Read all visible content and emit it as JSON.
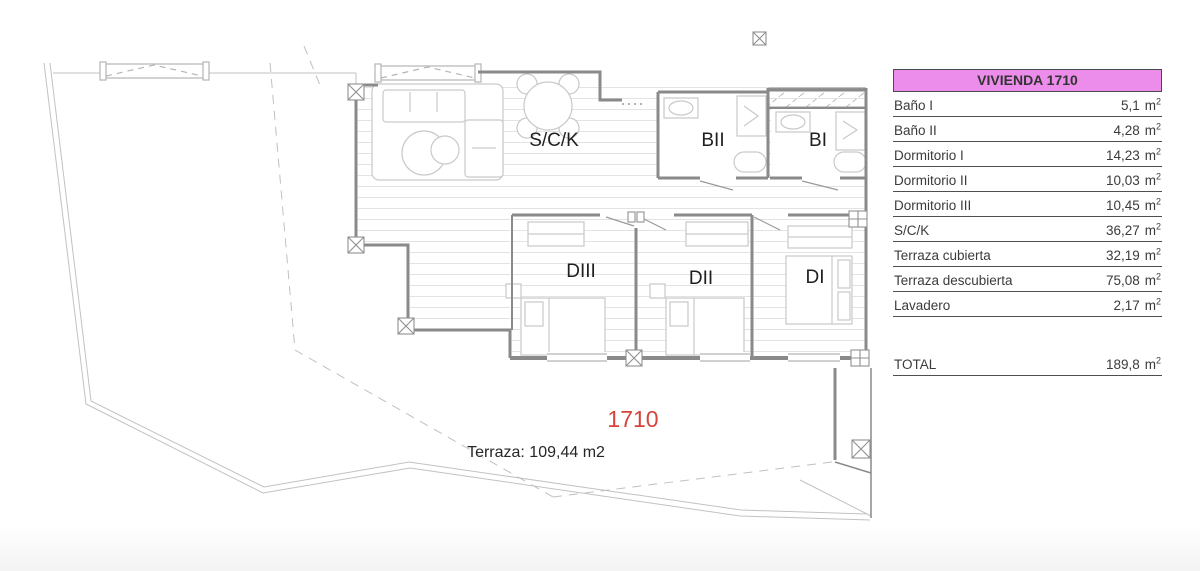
{
  "plan": {
    "unit_number": "1710",
    "unit_number_color": "#d6443c",
    "terrace_label": "Terraza: 109,44 m2",
    "rooms": {
      "sck": "S/C/K",
      "bii": "BII",
      "bi": "BI",
      "diii": "DIII",
      "dii": "DII",
      "di": "DI"
    }
  },
  "table": {
    "title": "VIVIENDA 1710",
    "title_bg": "#ec8deb",
    "unit": "m",
    "unit_sup": "2",
    "rows": [
      {
        "label": "Baño I",
        "value": "5,1"
      },
      {
        "label": "Baño II",
        "value": "4,28"
      },
      {
        "label": "Dormitorio I",
        "value": "14,23"
      },
      {
        "label": "Dormitorio II",
        "value": "10,03"
      },
      {
        "label": "Dormitorio III",
        "value": "10,45"
      },
      {
        "label": "S/C/K",
        "value": "36,27"
      },
      {
        "label": "Terraza cubierta",
        "value": "32,19"
      },
      {
        "label": "Terraza descubierta",
        "value": "75,08"
      },
      {
        "label": "Lavadero",
        "value": "2,17"
      }
    ],
    "total": {
      "label": "TOTAL",
      "value": "189,8"
    }
  }
}
